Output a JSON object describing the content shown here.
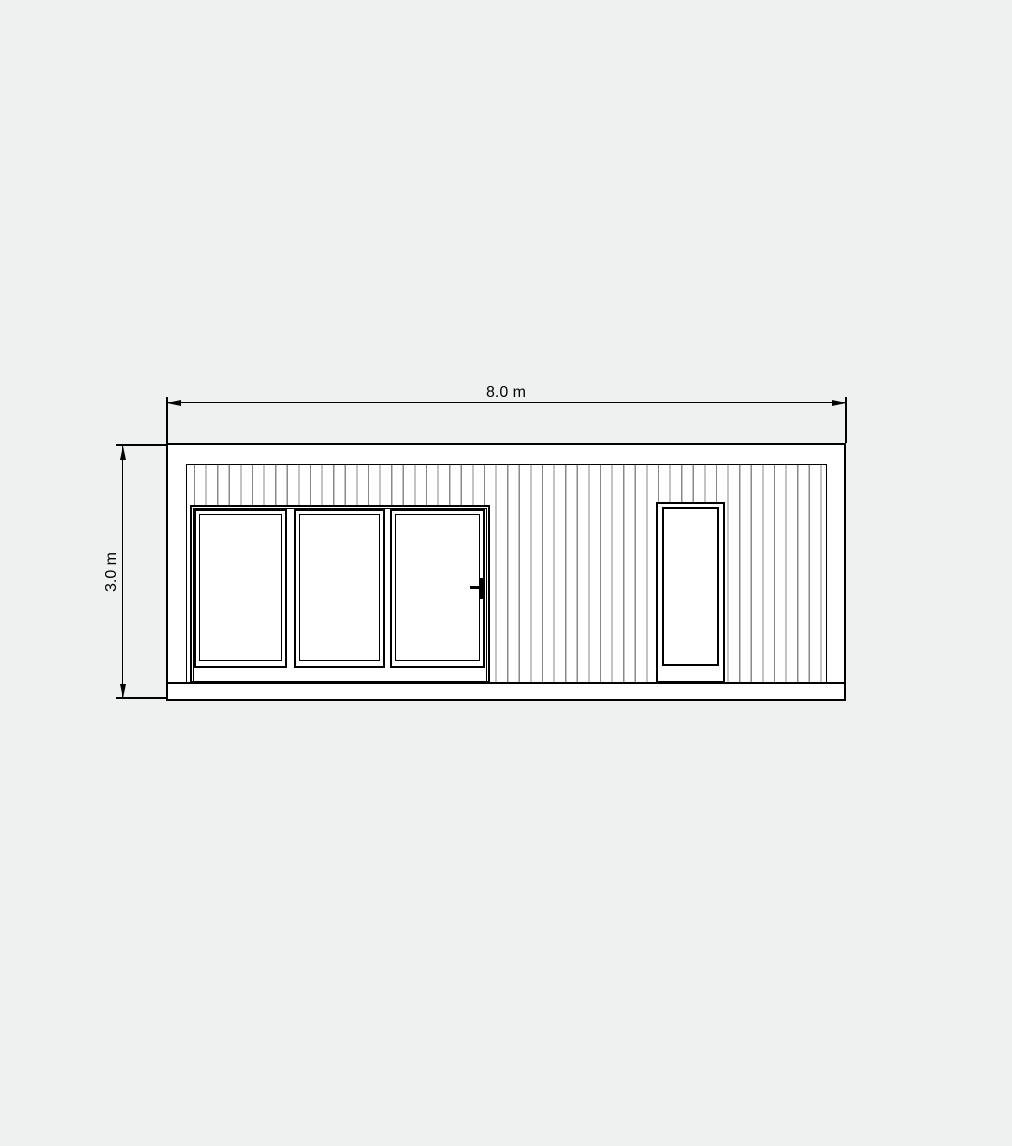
{
  "canvas": {
    "background_color": "#eff1f0",
    "line_color": "#000000",
    "siding_line_color": "#8a8a8a",
    "fill_color": "#ffffff"
  },
  "drawing": {
    "type": "architectural elevation",
    "subject": "front elevation of rectangular flat-roof cabin with vertical cladding",
    "dimension_top": {
      "label": "8.0 m"
    },
    "dimension_left": {
      "label": "3.0 m"
    },
    "features": {
      "sliding_door_panels": 3,
      "entry_doors": 1,
      "has_door_handle": true,
      "has_base_plinth": true,
      "cladding_style": "vertical siding lines"
    }
  }
}
